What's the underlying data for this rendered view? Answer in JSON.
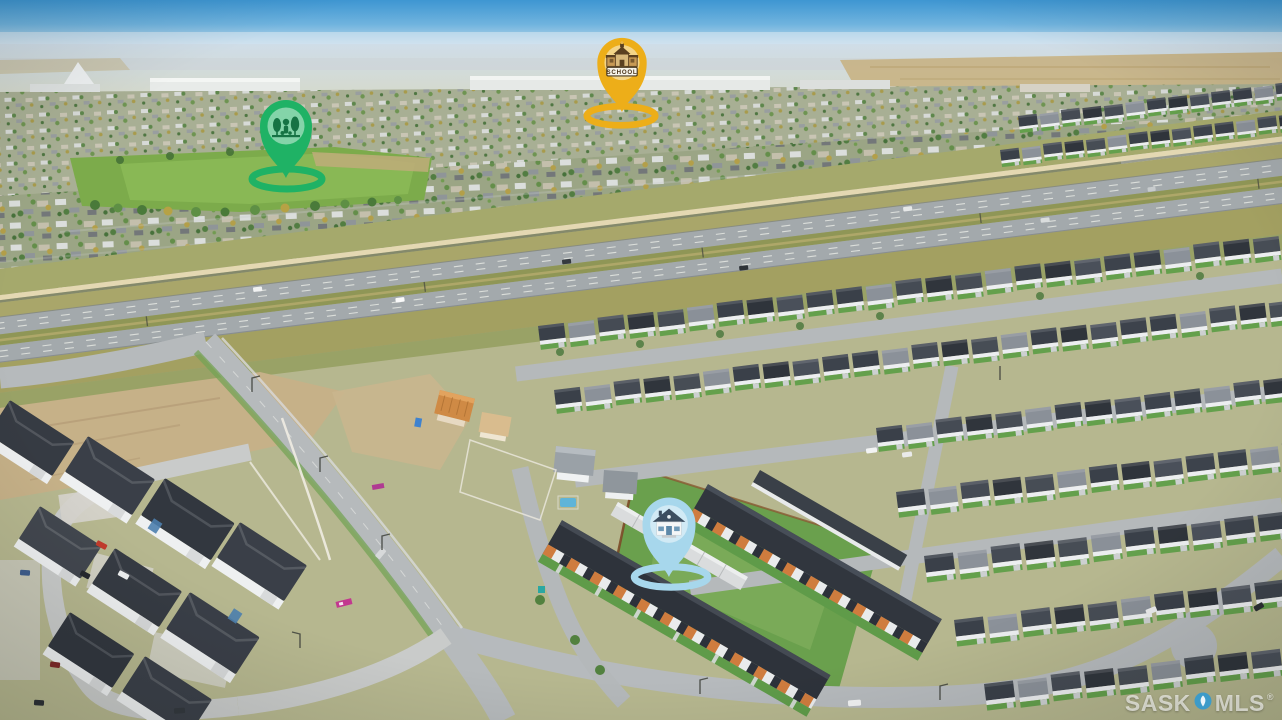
{
  "pins": {
    "park": {
      "color": "#1fb265",
      "icon": "park-trees-icon"
    },
    "school": {
      "color": "#edae19",
      "icon": "schoolhouse-icon",
      "label": "SCHOOL"
    },
    "home": {
      "color": "#a7d7ec",
      "icon": "house-icon"
    }
  },
  "watermark": {
    "prefix": "SASK",
    "suffix": "MLS",
    "registered": "®",
    "logo_color": "#2a9ad6"
  },
  "palette": {
    "sky": "#4da0d8",
    "haze": "#d4dcd3",
    "prairie_field": "#c8b284",
    "distant_suburb": "#9ba585",
    "park_green": "#7cab4b",
    "highway_asphalt": "#a3a9ac",
    "grass_olive": "#a5a96c",
    "sound_wall_tan": "#e4d8b2",
    "roof_charcoal": "#3a4049",
    "street_gray": "#b6babc",
    "lawn_green": "#64a04c",
    "dirt_tan": "#c6b188",
    "townhouse_wood_accent": "#cf7c3e"
  }
}
